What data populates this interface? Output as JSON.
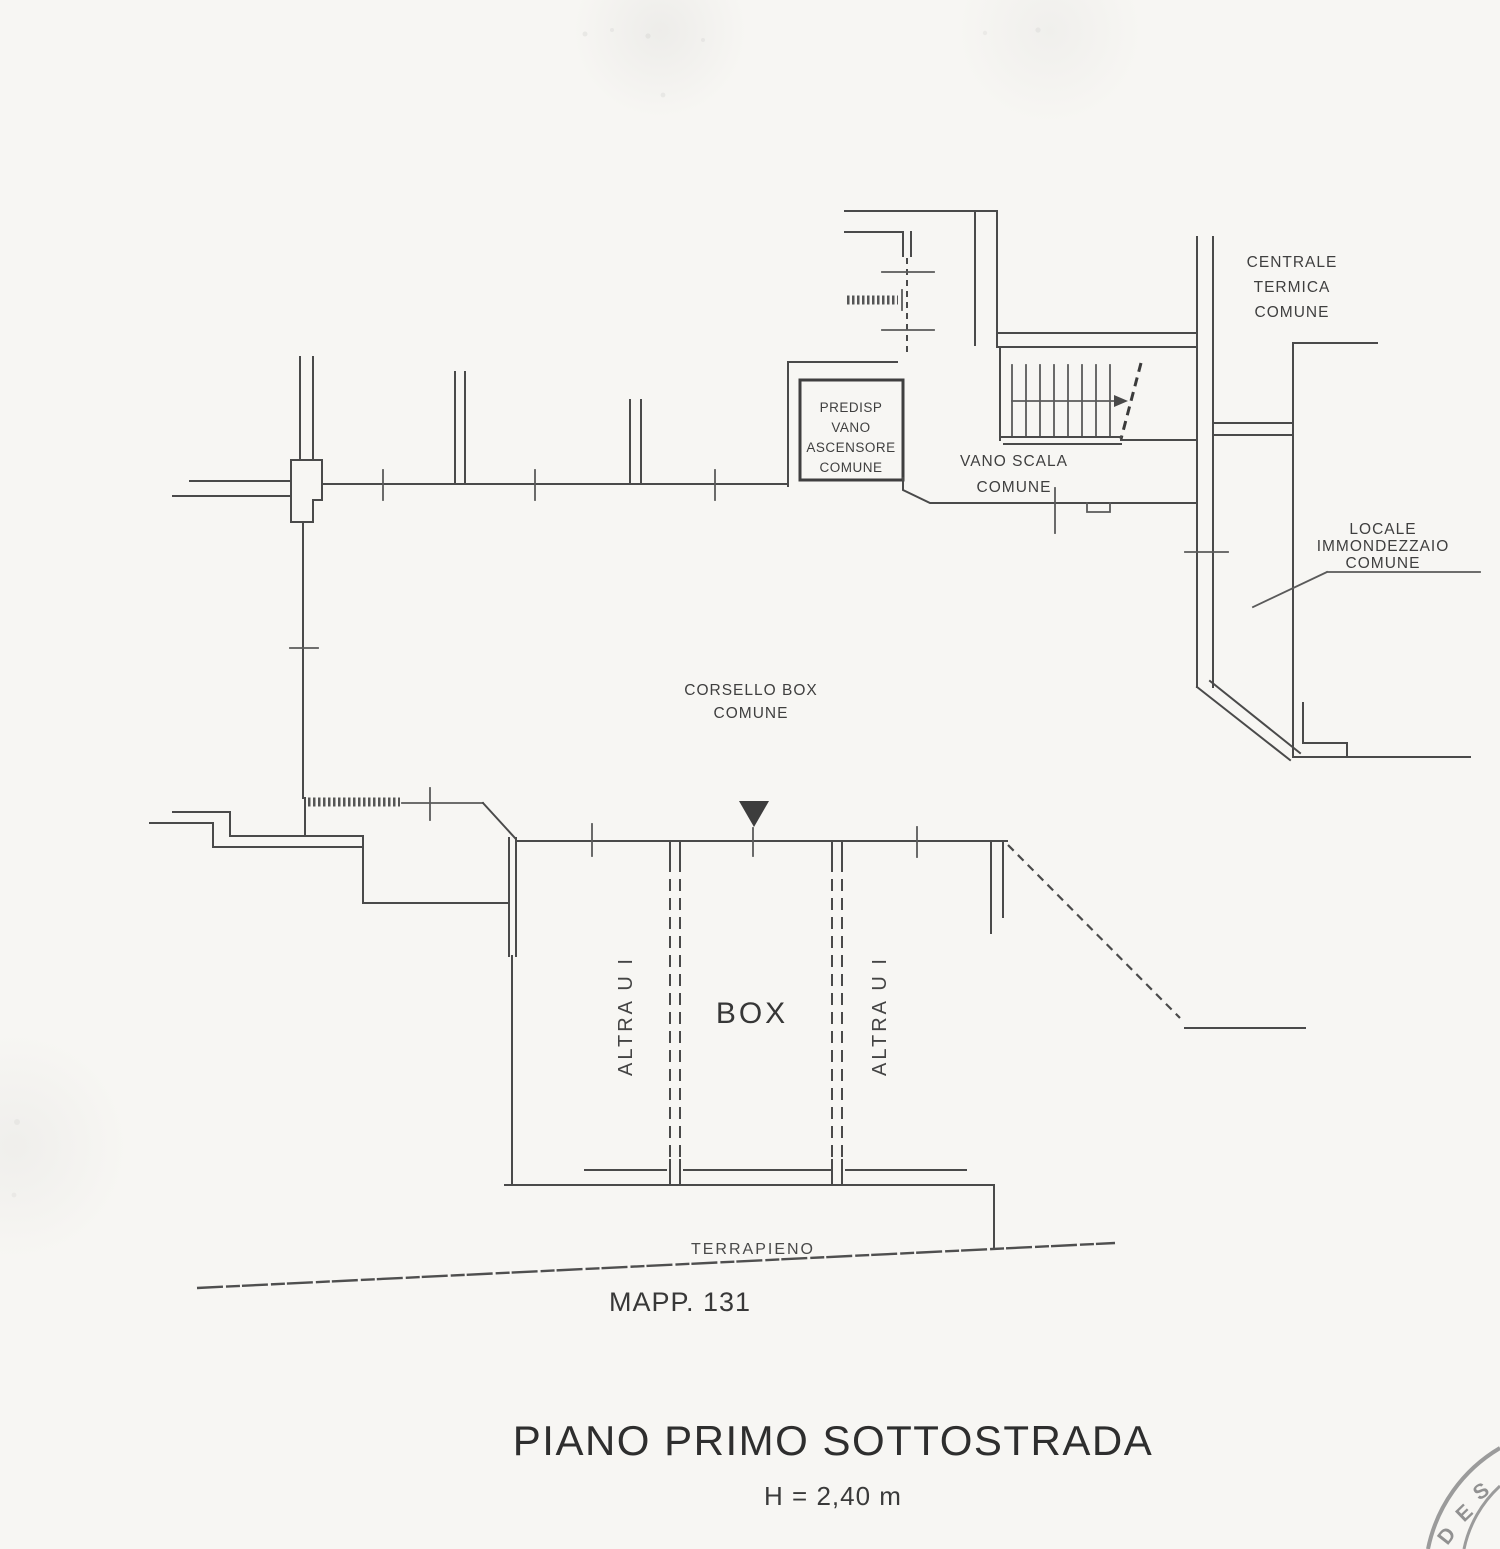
{
  "plan": {
    "labels": {
      "centrale_termica": {
        "lines": [
          "CENTRALE",
          "TERMICA",
          "COMUNE"
        ]
      },
      "predisp_ascensore": {
        "lines": [
          "PREDISP",
          "VANO",
          "ASCENSORE",
          "COMUNE"
        ]
      },
      "vano_scala": {
        "lines": [
          "VANO SCALA",
          "COMUNE"
        ]
      },
      "locale_immondezzaio": {
        "lines": [
          "LOCALE",
          "IMMONDEZZAIO",
          "COMUNE"
        ]
      },
      "corsello_box": {
        "lines": [
          "CORSELLO BOX",
          "COMUNE"
        ]
      },
      "box_unit": "BOX",
      "altra_ui_left": "ALTRA U I",
      "altra_ui_right": "ALTRA U I",
      "terrapieno": "TERRAPIENO",
      "mappale": "MAPP. 131"
    },
    "footer": {
      "title": "PIANO PRIMO SOTTOSTRADA",
      "height_note": "H = 2,40 m"
    },
    "stamp": {
      "letters": [
        "D",
        "E",
        "S"
      ]
    },
    "colors": {
      "ink": "#4a4a4a",
      "paper": "#f7f6f3",
      "stamp": "#8b8b8b"
    }
  }
}
